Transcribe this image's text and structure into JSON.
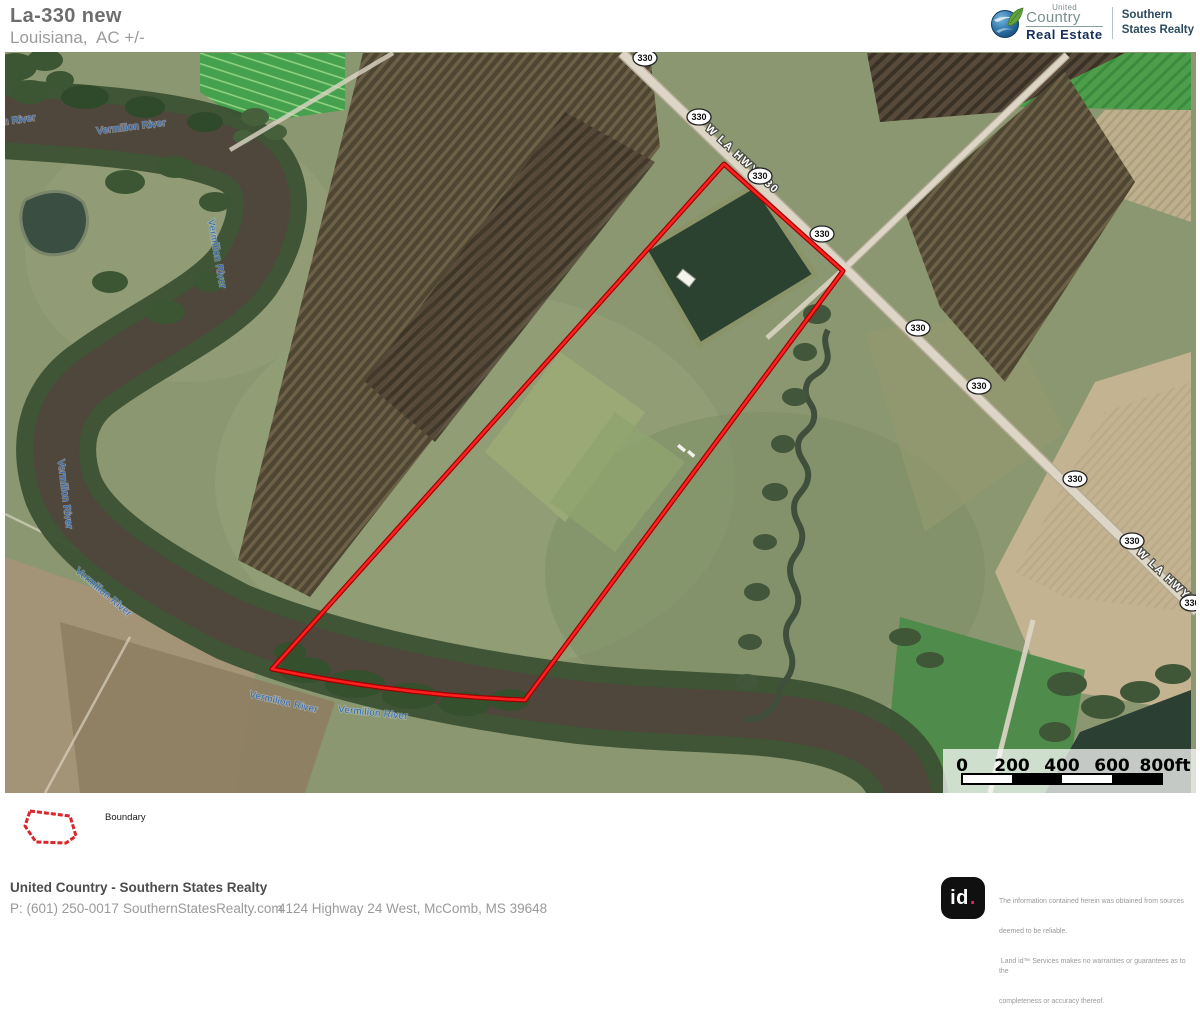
{
  "header": {
    "title": "La-330 new",
    "subtitle": "Louisiana,  AC +/-"
  },
  "brand": {
    "united": "United",
    "country": "Country",
    "real_estate": "Real Estate",
    "division_line1": "Southern",
    "division_line2": "States Realty"
  },
  "map": {
    "river_label": "Vermilion River",
    "road_label": "W LA HWY 330",
    "shield_label": "330",
    "scale_labels": {
      "l0": "0",
      "l200": "200",
      "l400": "400",
      "l600": "600",
      "l800": "800ft"
    }
  },
  "legend": {
    "boundary": "Boundary"
  },
  "footer": {
    "company": "United Country - Southern States Realty",
    "phone": "P: (601) 250-0017",
    "website": "SouthernStatesRealty.com",
    "address": "4124 Highway 24 West, McComb, MS 39648"
  },
  "attribution": {
    "logo_id": "id",
    "logo_dot": ".",
    "line1": "The information contained herein was obtained from sources",
    "line2": "deemed to be reliable.",
    "line3": " Land id™ Services makes no warranties or guarantees as to the",
    "line4": "completeness or accuracy thereof."
  },
  "colors": {
    "boundary_red": "#f01818",
    "river_label_blue": "#2d6ab5",
    "water_brown": "#4f463c",
    "brand_navy": "#182f5c",
    "brand_green": "#64a43e",
    "landid_pink": "#d6246e"
  }
}
